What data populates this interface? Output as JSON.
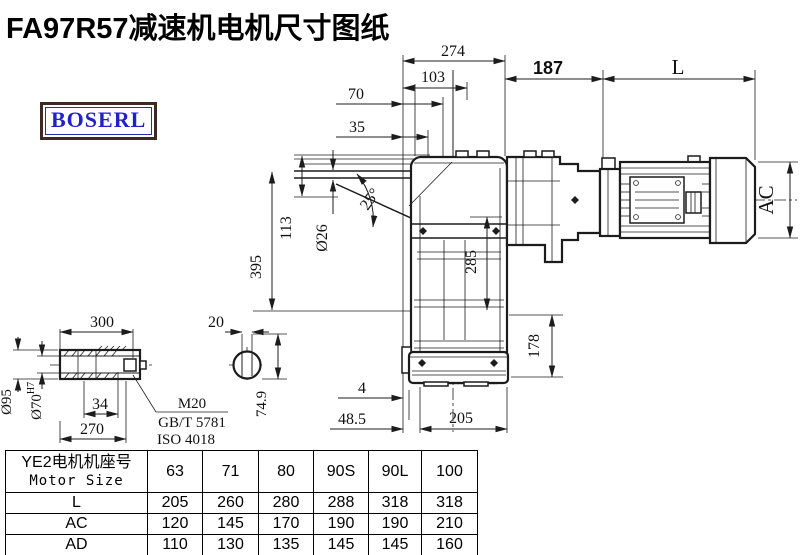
{
  "title": "FA97R57减速机电机尺寸图纸",
  "brand": {
    "logo_text": "BOSERL"
  },
  "drawing": {
    "dims": {
      "overall_width": "274",
      "width_103": "103",
      "width_70": "70",
      "width_35": "35",
      "adapter_length": "187",
      "motor_length": "L",
      "motor_diameter": "AC",
      "torque_arm_angle": "25°",
      "hole_dia": "Ø26",
      "height_113": "113",
      "height_395": "395",
      "height_285": "285",
      "flange_height": "178",
      "gap_4": "4",
      "offset_48_5": "48.5",
      "base_width": "205"
    },
    "shaft_detail": {
      "length_300": "300",
      "key_width": "20",
      "outer_dia": "Ø95",
      "bore_dia": "Ø70",
      "bore_tol": "H7",
      "key_34": "34",
      "length_270": "270",
      "thread": "M20",
      "std_gb": "GB/T 5781",
      "std_iso": "ISO 4018",
      "key_height": "74.9"
    }
  },
  "table": {
    "header_cn": "YE2电机机座号",
    "header_en": "Motor Size",
    "sizes": [
      "63",
      "71",
      "80",
      "90S",
      "90L",
      "100"
    ],
    "rows": [
      {
        "label": "L",
        "values": [
          "205",
          "260",
          "280",
          "288",
          "318",
          "318"
        ]
      },
      {
        "label": "AC",
        "values": [
          "120",
          "145",
          "170",
          "190",
          "190",
          "210"
        ]
      },
      {
        "label": "AD",
        "values": [
          "110",
          "130",
          "135",
          "145",
          "145",
          "160"
        ]
      }
    ]
  },
  "colors": {
    "line": "#1c1c1c",
    "logo_text": "#2222c4",
    "logo_border": "#3e2a22"
  }
}
